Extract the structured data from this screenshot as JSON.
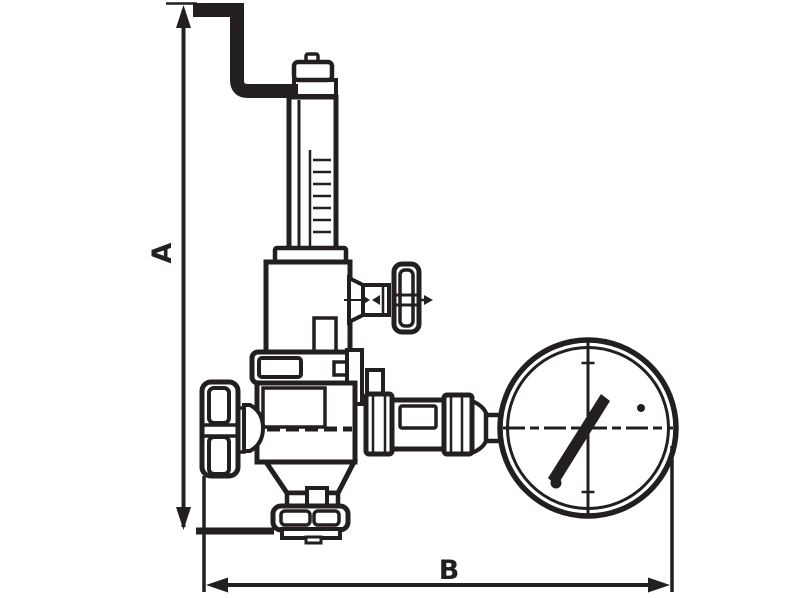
{
  "drawing": {
    "type": "technical-line-drawing",
    "subject": "pressure reducing valve with spring bonnet, side relief handwheel and pressure gauge",
    "colors": {
      "line": "#231f20",
      "background": "#ffffff"
    },
    "dimensions": {
      "vertical_label": "A",
      "horizontal_label": "B"
    },
    "components": [
      "bent-pipe-handle",
      "adjusting-screw-cap",
      "spring-bonnet-tube",
      "spring-housing",
      "relief-branch-handwheel",
      "body-flange-band",
      "valve-body",
      "inlet-handwheel",
      "bottom-union-nut",
      "outlet-coupling",
      "pressure-gauge"
    ]
  }
}
